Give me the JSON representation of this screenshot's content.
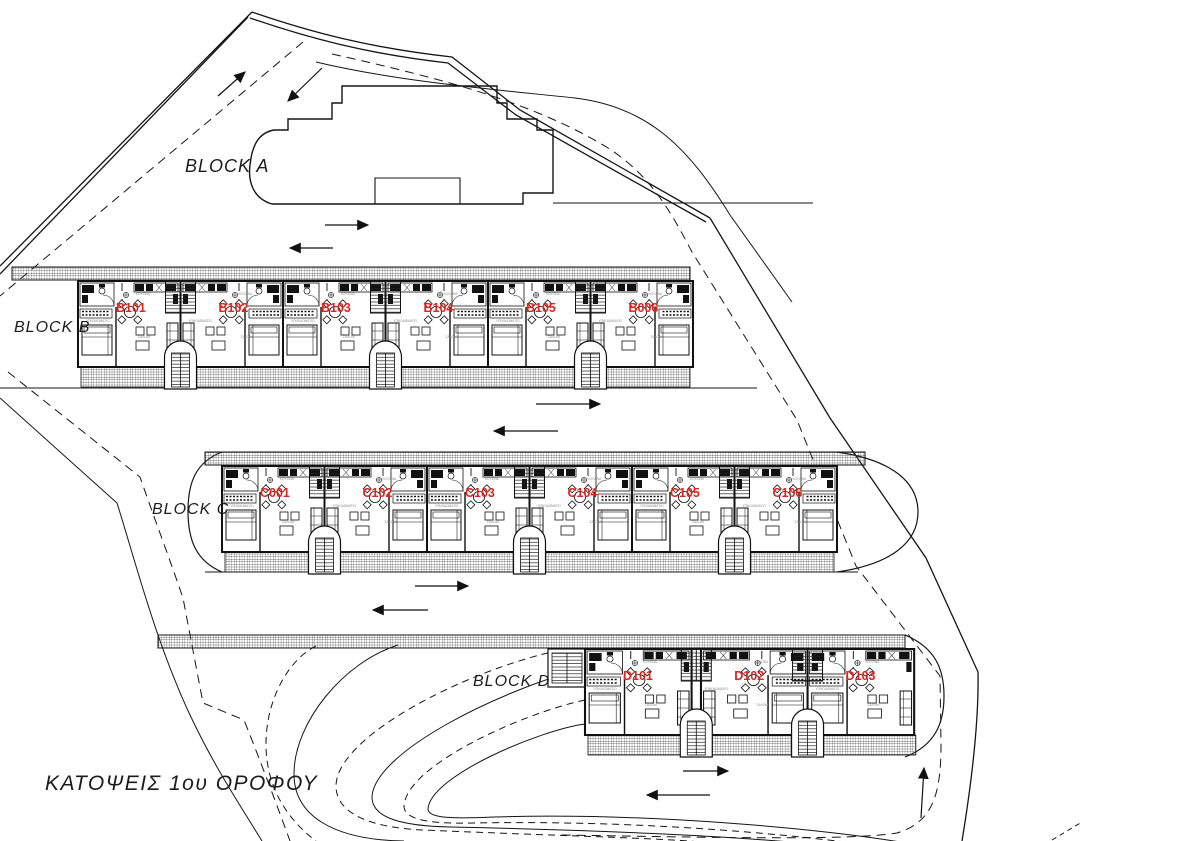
{
  "title": {
    "text": "ΚΑΤΟΨΕΙΣ 1ου ΟΡΟΦΟΥ"
  },
  "colors": {
    "unit_label": "#e02420",
    "line": "#151515"
  },
  "unit_room_labels": {
    "kitchen": "ΚΟΥΖΙΝΑ",
    "bedroom": "ΥΠΝΟΔΩΜΑΤΙΟ",
    "living": "ΣΑΛΟΝΙ"
  },
  "blocks": [
    {
      "id": "A",
      "label": "BLOCK A",
      "label_x": 185,
      "label_y": 172
    },
    {
      "id": "B",
      "label": "BLOCK B",
      "label_x": 14,
      "label_y": 332,
      "row": {
        "x": 78,
        "y": 281,
        "w": 102.5,
        "h": 86,
        "n": 6,
        "sx": 1.0,
        "pairs": [
          1,
          3,
          5
        ]
      },
      "strip": {
        "x": 12,
        "y": 267,
        "w": 678
      },
      "units": [
        "B101",
        "B102",
        "B103",
        "B104",
        "B105",
        "B006"
      ]
    },
    {
      "id": "C",
      "label": "BLOCK C",
      "label_x": 152,
      "label_y": 514,
      "row": {
        "x": 222,
        "y": 466,
        "w": 102.5,
        "h": 86,
        "n": 6,
        "sx": 1.0,
        "pairs": [
          1,
          3,
          5
        ]
      },
      "strip": {
        "x": 205,
        "y": 452,
        "w": 660
      },
      "units": [
        "C001",
        "C102",
        "C103",
        "C104",
        "C105",
        "C106"
      ]
    },
    {
      "id": "D",
      "label": "BLOCK D",
      "label_x": 473,
      "label_y": 686,
      "row": {
        "x": 585,
        "y": 649,
        "w": 107,
        "h": 86,
        "n": 3,
        "sx": 1.04,
        "pairs": [
          1,
          2
        ]
      },
      "strip": {
        "x": 158,
        "y": 635,
        "w": 747
      },
      "units": [
        "D101",
        "D102",
        "D103"
      ]
    }
  ]
}
